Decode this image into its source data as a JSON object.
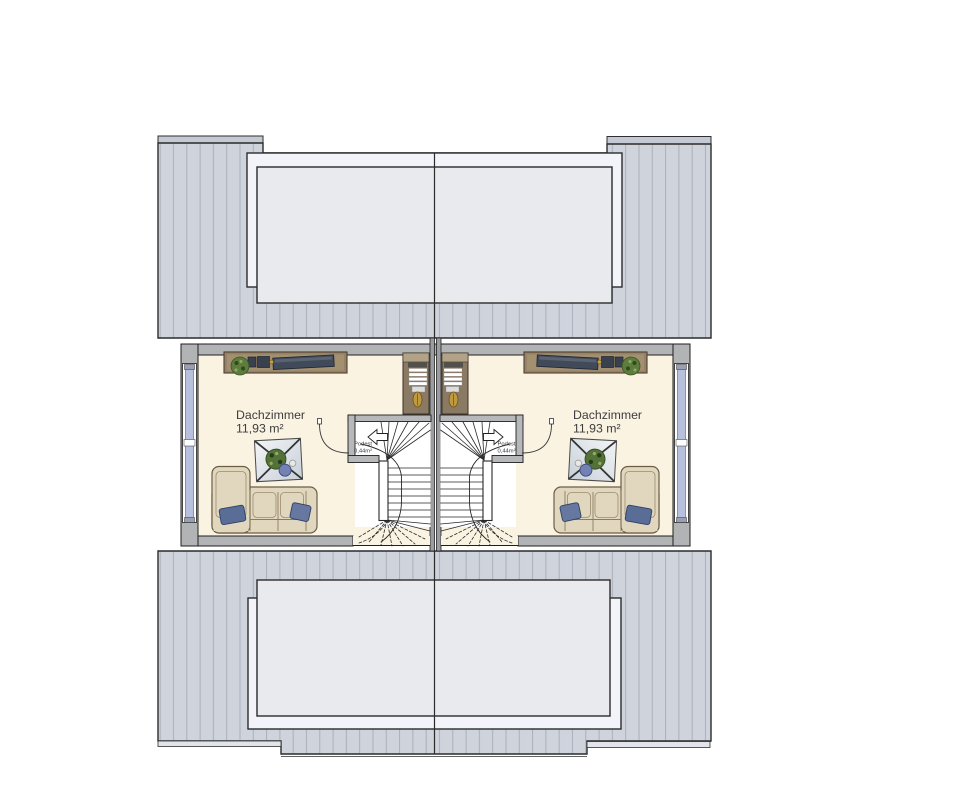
{
  "plan": {
    "type": "attic floor plan of a semi-detached house (two mirrored units)",
    "rooms": [
      {
        "label": "Dachzimmer",
        "area": "11,93 m²",
        "side": "left"
      },
      {
        "label": "Dachzimmer",
        "area": "11,93 m²",
        "side": "right"
      }
    ],
    "stairs": [
      {
        "landing_label": "Podest",
        "landing_area": "0,44m²",
        "side": "left"
      },
      {
        "landing_label": "Podest",
        "landing_area": "0,44m²",
        "side": "right"
      }
    ]
  },
  "colors": {
    "background": "#ffffff",
    "roof_fill": "#ced3dc",
    "roof_stripe": "#a6acb9",
    "roof_fascia_top": "#c5c9d3",
    "roof_fascia_bottom": "#e1e4ea",
    "skylight_outer": "#f2f4f9",
    "skylight_inner": "#e9eaed",
    "outline": "#2b2b2b",
    "floor": "#faf3e2",
    "wall": "#b2b3b5",
    "party_wall": "#9c9da0",
    "window_glass": "#b7c1dd",
    "stair_white": "#ffffff",
    "sofa": "#e1d7bf",
    "pillow": "#5a6d97",
    "wood_desk": "#96826a",
    "wood_wardrobe": "#8b7a63",
    "plant_green": "#5e7c3d",
    "table_top": "#e7ebf0",
    "gold_object": "#c09a3f",
    "text": "#3d3d3d"
  }
}
